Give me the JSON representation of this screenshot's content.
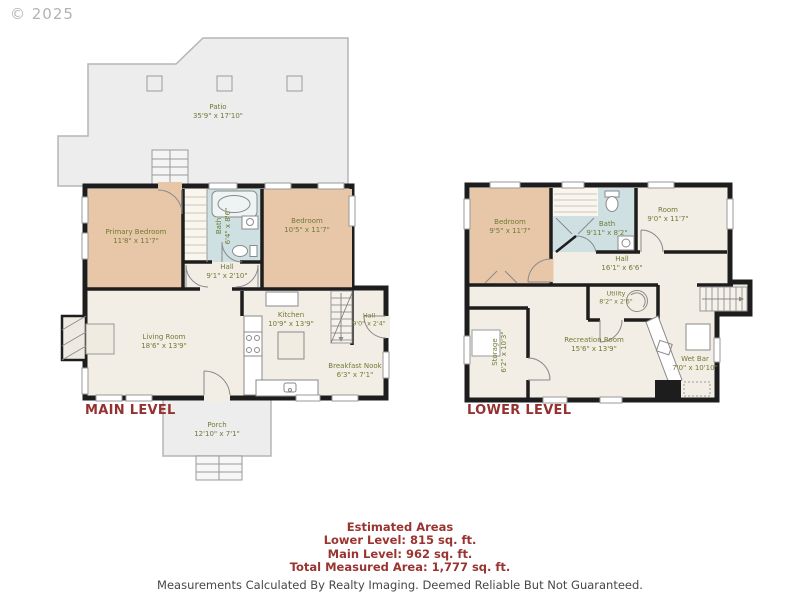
{
  "copyright": "© 2025",
  "colors": {
    "wall": "#1d1d1d",
    "bedroom_fill": "#e8c7a9",
    "bath_fill": "#cfe0e2",
    "room_fill": "#f3eee5",
    "outdoor_fill": "#ededed",
    "label_green": "#6e7b35",
    "heading_red": "#943230",
    "footer_gray": "#474747"
  },
  "main_level": {
    "label": "MAIN LEVEL",
    "rooms": [
      {
        "name": "Patio",
        "dims": "35'9\" x 17'10\""
      },
      {
        "name": "Primary Bedroom",
        "dims": "11'8\" x 11'7\""
      },
      {
        "name": "Bath",
        "dims": "6'4\" x 8'6\""
      },
      {
        "name": "Bedroom",
        "dims": "10'5\" x 11'7\""
      },
      {
        "name": "Hall",
        "dims": "9'1\" x 2'10\""
      },
      {
        "name": "Living Room",
        "dims": "18'6\" x 13'9\""
      },
      {
        "name": "Kitchen",
        "dims": "10'9\" x 13'9\""
      },
      {
        "name": "Hall",
        "dims": "9'0\" x 2'4\""
      },
      {
        "name": "Breakfast Nook",
        "dims": "6'3\" x 7'1\""
      },
      {
        "name": "Porch",
        "dims": "12'10\" x 7'1\""
      }
    ]
  },
  "lower_level": {
    "label": "LOWER LEVEL",
    "rooms": [
      {
        "name": "Bedroom",
        "dims": "9'5\" x 11'7\""
      },
      {
        "name": "Bath",
        "dims": "9'11\" x 8'2\""
      },
      {
        "name": "Room",
        "dims": "9'0\" x 11'7\""
      },
      {
        "name": "Hall",
        "dims": "16'1\" x 6'6\""
      },
      {
        "name": "Utility",
        "dims": "8'2\" x 2'6\""
      },
      {
        "name": "Storage",
        "dims": "6'2\" x 10'3\""
      },
      {
        "name": "Recreation Room",
        "dims": "15'6\" x 13'9\""
      },
      {
        "name": "Wet Bar",
        "dims": "7'0\" x 10'10\""
      }
    ]
  },
  "footer": {
    "title": "Estimated Areas",
    "lower_level": "Lower Level: 815 sq. ft.",
    "main_level": "Main Level: 962 sq. ft.",
    "total": "Total Measured Area: 1,777 sq. ft.",
    "disclaimer": "Measurements Calculated By Realty Imaging.  Deemed Reliable But Not Guaranteed."
  }
}
